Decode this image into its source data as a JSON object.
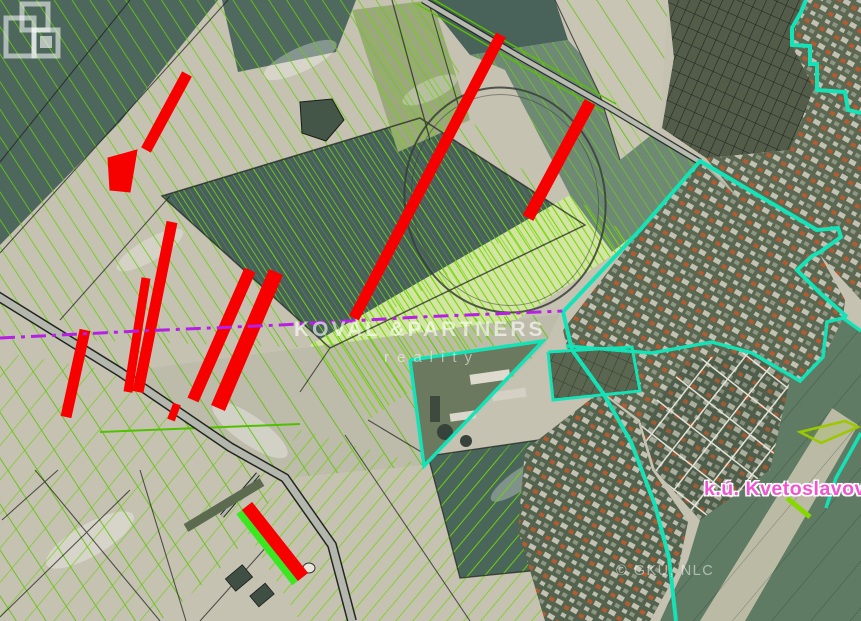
{
  "map": {
    "watermark": {
      "brand": "KOVAL &PARTNERS",
      "tagline": "reality"
    },
    "labels": {
      "cadastral_unit": "k.ú. Kvetoslavov",
      "attribution": "© GKÚ, NLC"
    },
    "legend": {
      "highlighted_parcel_color": "#F60000",
      "parcel_line_color": "#66CF05",
      "boundary_cyan_color": "#14E3B8",
      "boundary_purple_color": "#B81FE6",
      "cadastral_label_color": "#F055D2"
    }
  }
}
